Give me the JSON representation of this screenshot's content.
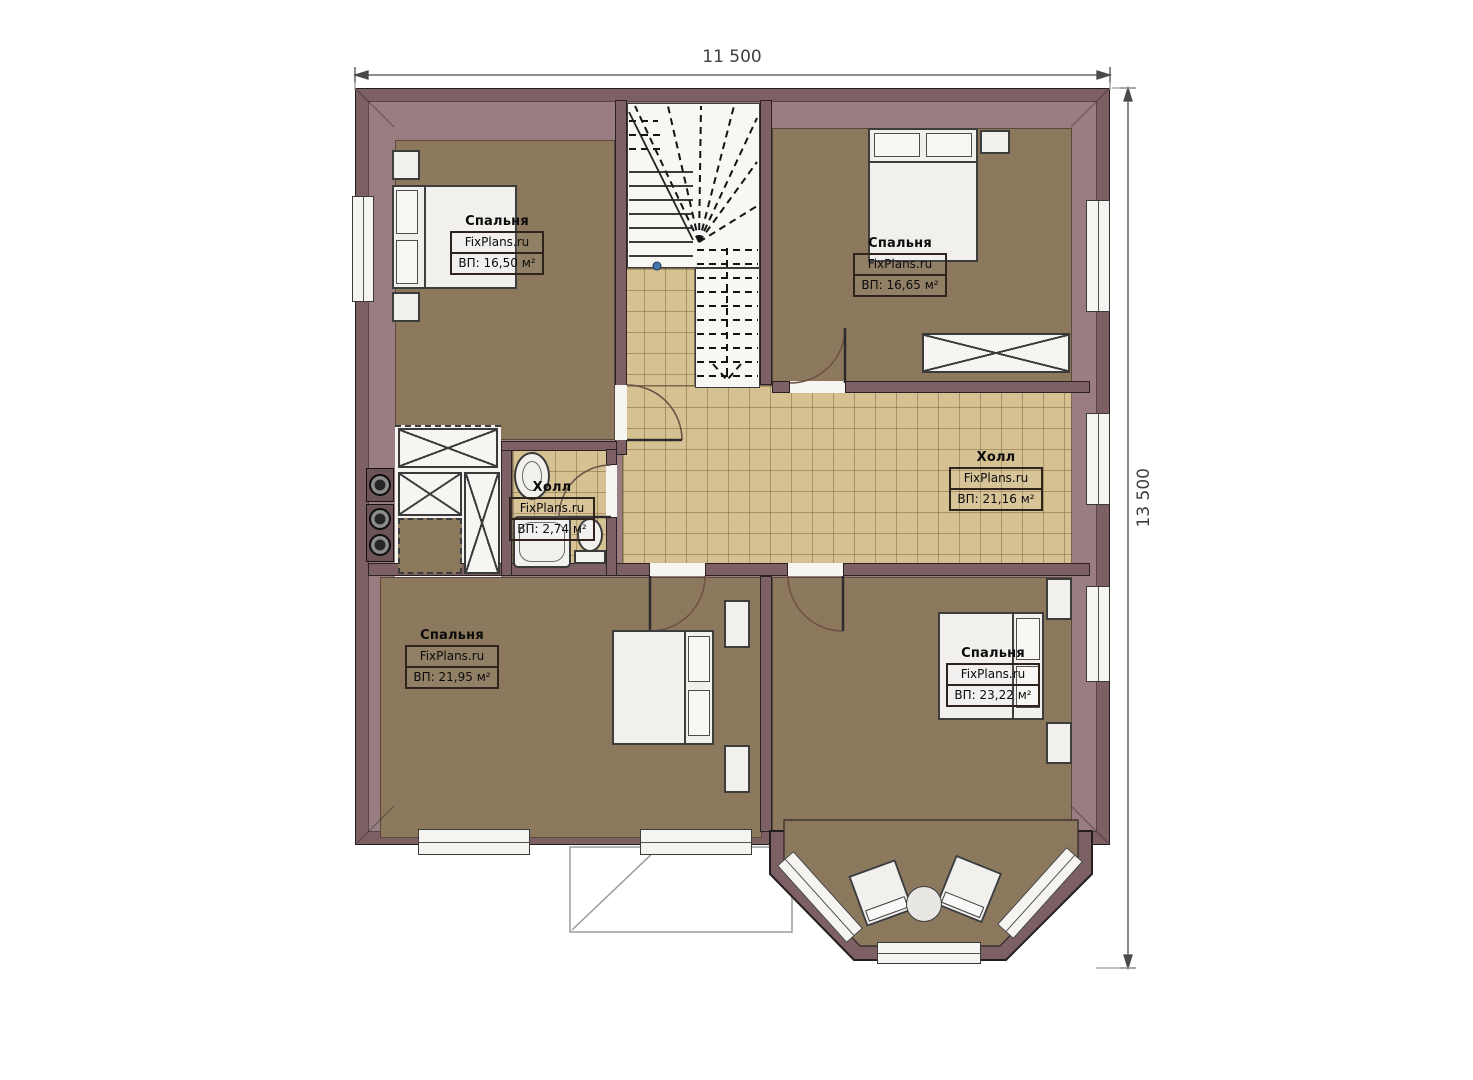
{
  "plan": {
    "dim_width": "11 500",
    "dim_height": "13 500"
  },
  "rooms": [
    {
      "name": "Спальня",
      "brand": "FixPlans.ru",
      "area": "ВП: 16,50 м²"
    },
    {
      "name": "Спальня",
      "brand": "FixPlans.ru",
      "area": "ВП: 16,65 м²"
    },
    {
      "name": "Холл",
      "brand": "FixPlans.ru",
      "area": "ВП: 21,16 м²"
    },
    {
      "name": "Холл",
      "brand": "FixPlans.ru",
      "area": "ВП: 2,74 м²"
    },
    {
      "name": "Спальня",
      "brand": "FixPlans.ru",
      "area": "ВП: 21,95 м²"
    },
    {
      "name": "Спальня",
      "brand": "FixPlans.ru",
      "area": "ВП: 23,22 м²"
    }
  ],
  "colors": {
    "exterior_wall": "#7c6064",
    "attic_band": "#9a7d80",
    "carpet_floor": "#8c795d",
    "tile_floor": "#d6c193",
    "furniture": "#f1f0ed",
    "background": "#ffffff"
  }
}
